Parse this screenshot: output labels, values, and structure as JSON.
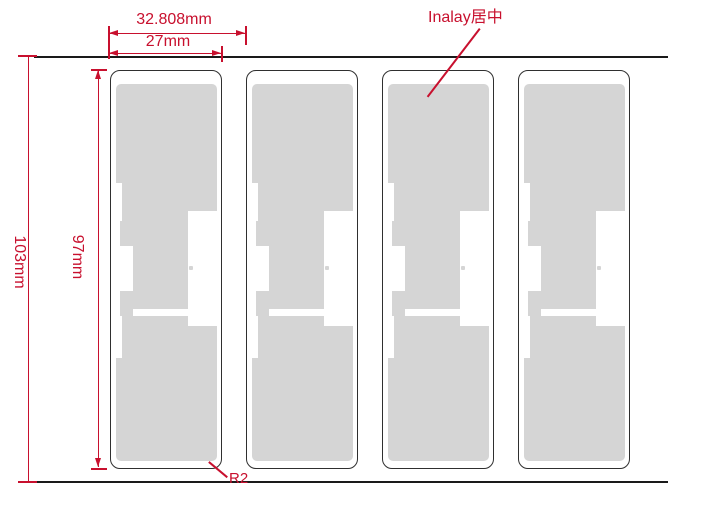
{
  "drawing": {
    "type": "rfid-inlay-label-die-layout",
    "tag_count": 4,
    "dimensions": {
      "pitch_label": "32.808mm",
      "tag_width_label": "27mm",
      "web_height_label": "103mm",
      "tag_height_label": "97mm",
      "corner_radius_label": "R2"
    },
    "callouts": {
      "inlay_centered": "Inalay居中"
    },
    "colors": {
      "dimension_red": "#c8102e",
      "line_black": "#1a1a1a",
      "antenna_gray": "#d5d5d5",
      "tag_border": "#2f2f2f",
      "background": "#ffffff"
    }
  }
}
